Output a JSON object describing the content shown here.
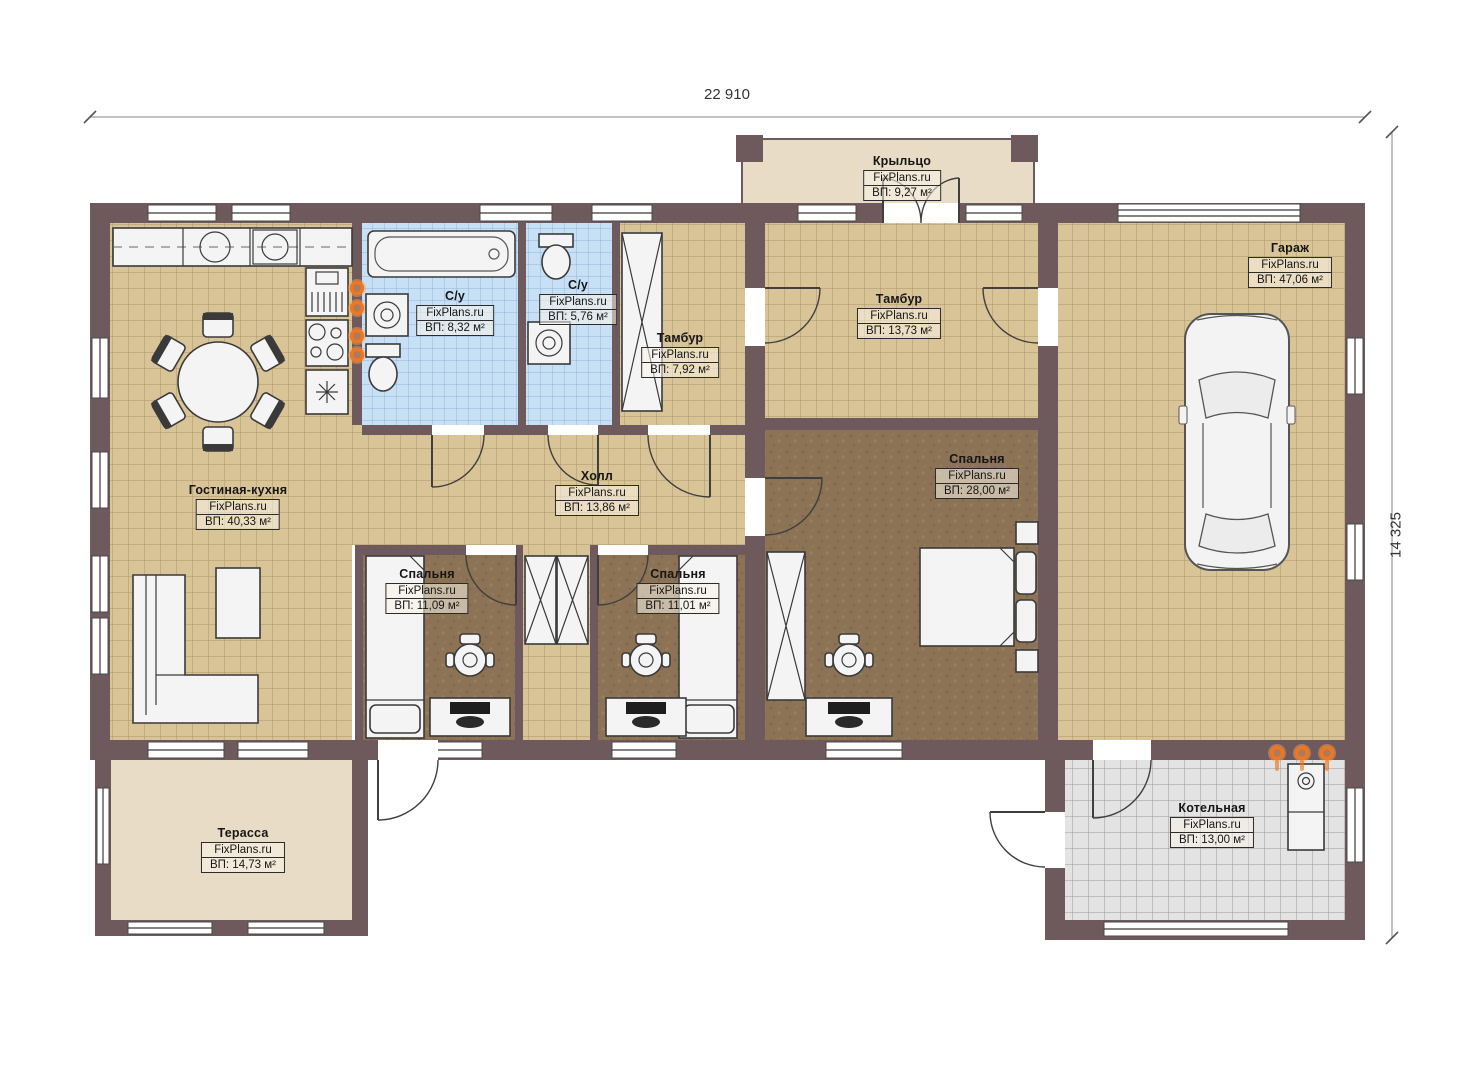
{
  "site_brand": "FixPlans.ru",
  "dimensions": {
    "top_width_mm": "22 910",
    "right_height_mm": "14 325"
  },
  "rooms": [
    {
      "id": "porch",
      "name": "Крыльцо",
      "brand": "FixPlans.ru",
      "area": "ВП: 9,27 м²"
    },
    {
      "id": "garage",
      "name": "Гараж",
      "brand": "FixPlans.ru",
      "area": "ВП: 47,06 м²"
    },
    {
      "id": "vestibule-main",
      "name": "Тамбур",
      "brand": "FixPlans.ru",
      "area": "ВП: 13,73 м²"
    },
    {
      "id": "vestibule-small",
      "name": "Тамбур",
      "brand": "FixPlans.ru",
      "area": "ВП: 7,92 м²"
    },
    {
      "id": "bathroom-1",
      "name": "С/у",
      "brand": "FixPlans.ru",
      "area": "ВП: 8,32 м²"
    },
    {
      "id": "bathroom-2",
      "name": "С/у",
      "brand": "FixPlans.ru",
      "area": "ВП: 5,76 м²"
    },
    {
      "id": "living-kitchen",
      "name": "Гостиная-кухня",
      "brand": "FixPlans.ru",
      "area": "ВП: 40,33 м²"
    },
    {
      "id": "hall",
      "name": "Холл",
      "brand": "FixPlans.ru",
      "area": "ВП: 13,86 м²"
    },
    {
      "id": "bedroom-master",
      "name": "Спальня",
      "brand": "FixPlans.ru",
      "area": "ВП: 28,00 м²"
    },
    {
      "id": "bedroom-2",
      "name": "Спальня",
      "brand": "FixPlans.ru",
      "area": "ВП: 11,09 м²"
    },
    {
      "id": "bedroom-3",
      "name": "Спальня",
      "brand": "FixPlans.ru",
      "area": "ВП: 11,01 м²"
    },
    {
      "id": "terrace",
      "name": "Терасса",
      "brand": "FixPlans.ru",
      "area": "ВП: 14,73 м²"
    },
    {
      "id": "boiler-room",
      "name": "Котельная",
      "brand": "FixPlans.ru",
      "area": "ВП: 13,00 м²"
    }
  ],
  "colors": {
    "wall": "#6e5a5c",
    "floor_tile_beige": "#d9c497",
    "floor_bedroom_brown": "#8c7355",
    "floor_bath_blue": "#c8e0f6",
    "floor_boiler_gray": "#e3e3e3",
    "floor_porch_terrace": "#e9dcc6",
    "heating_accent": "#ef7722"
  }
}
